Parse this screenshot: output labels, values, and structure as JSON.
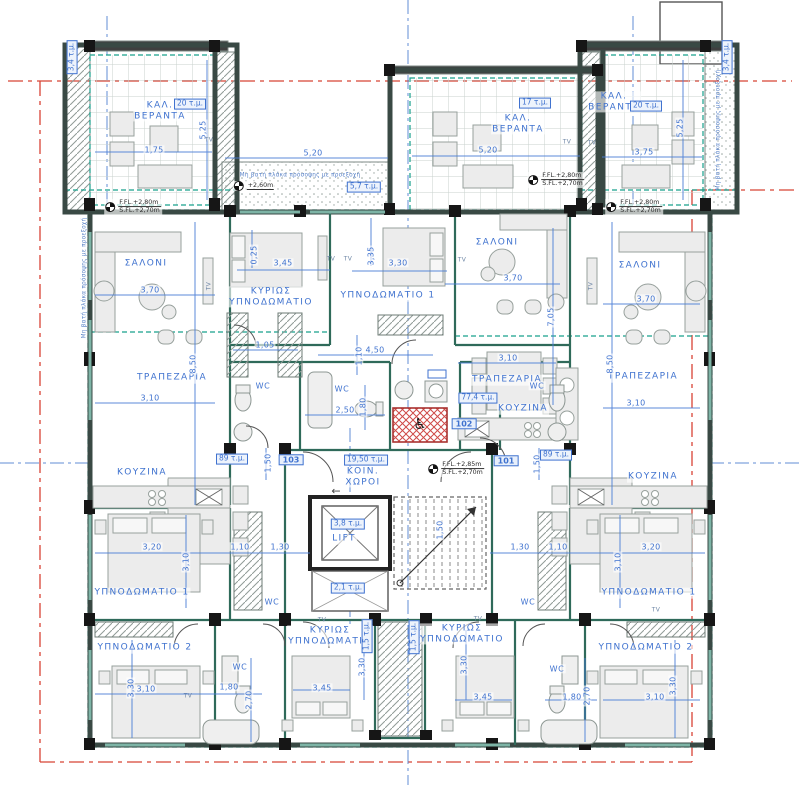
{
  "meta": {
    "drawing_type": "apartment-building-floor-plan",
    "colors": {
      "annotation_blue": "#3f72cf",
      "wall_dark": "#394944",
      "partition_teal": "#2f6a5a",
      "boundary_red": "#d84335",
      "axis_blue": "#4f7fd0",
      "envelope_teal": "#17a08c"
    }
  },
  "labels": [
    {
      "t": "ΣΑΛΟΝΙ",
      "x": 146,
      "y": 264,
      "c": "room"
    },
    {
      "t": "ΤΡΑΠΕΖΑΡΙΑ",
      "x": 172,
      "y": 378,
      "c": "room"
    },
    {
      "t": "ΚΟΥΖΙΝΑ",
      "x": 142,
      "y": 473,
      "c": "room"
    },
    {
      "t": "ΥΠΝΟΔΩΜΑΤΙΟ 1",
      "x": 142,
      "y": 593,
      "c": "room"
    },
    {
      "t": "ΥΠΝΟΔΩΜΑΤΙΟ 2",
      "x": 145,
      "y": 648,
      "c": "room"
    },
    {
      "t": "ΚΥΡΙΩΣ\nΥΠΝΟΔΩΜΑΤΙΟ",
      "x": 271,
      "y": 297,
      "c": "room"
    },
    {
      "t": "ΥΠΝΟΔΩΜΑΤΙΟ 1",
      "x": 388,
      "y": 296,
      "c": "room"
    },
    {
      "t": "ΣΑΛΟΝΙ",
      "x": 497,
      "y": 243,
      "c": "room"
    },
    {
      "t": "ΤΡΑΠΕΖΑΡΙΑ",
      "x": 507,
      "y": 380,
      "c": "room"
    },
    {
      "t": "ΚΟΥΖΙΝΑ",
      "x": 523,
      "y": 409,
      "c": "room"
    },
    {
      "t": "ΣΑΛΟΝΙ",
      "x": 640,
      "y": 266,
      "c": "room"
    },
    {
      "t": "ΤΡΑΠΕΖΑΡΙΑ",
      "x": 643,
      "y": 377,
      "c": "room"
    },
    {
      "t": "ΚΟΥΖΙΝΑ",
      "x": 653,
      "y": 477,
      "c": "room"
    },
    {
      "t": "ΥΠΝΟΔΩΜΑΤΙΟ 1",
      "x": 649,
      "y": 593,
      "c": "room"
    },
    {
      "t": "ΥΠΝΟΔΩΜΑΤΙΟ 2",
      "x": 646,
      "y": 648,
      "c": "room"
    },
    {
      "t": "ΚΥΡΙΩΣ\nΥΠΝΟΔΩΜΑΤΙΟ",
      "x": 330,
      "y": 636,
      "c": "room"
    },
    {
      "t": "ΚΥΡΙΩΣ\nΥΠΝΟΔΩΜΑΤΙΟ",
      "x": 462,
      "y": 634,
      "c": "room"
    },
    {
      "t": "ΚΑΛ.\nΒΕΡΑΝΤΑ",
      "x": 160,
      "y": 111,
      "c": "room"
    },
    {
      "t": "ΚΑΛ.\nΒΕΡΑΝΤΑ",
      "x": 518,
      "y": 124,
      "c": "room"
    },
    {
      "t": "ΚΑΛ.\nΒΕΡΑΝΤΑ",
      "x": 614,
      "y": 102,
      "c": "room"
    },
    {
      "t": "ΚΟΙΝ.\nΧΩΡΟΙ",
      "x": 363,
      "y": 477,
      "c": "room"
    },
    {
      "t": "LIFT",
      "x": 344,
      "y": 539,
      "c": "room"
    },
    {
      "t": "WC",
      "x": 263,
      "y": 386,
      "c": "wc"
    },
    {
      "t": "WC",
      "x": 342,
      "y": 389,
      "c": "wc"
    },
    {
      "t": "WC",
      "x": 537,
      "y": 386,
      "c": "wc"
    },
    {
      "t": "WC",
      "x": 272,
      "y": 602,
      "c": "wc"
    },
    {
      "t": "WC",
      "x": 528,
      "y": 602,
      "c": "wc"
    },
    {
      "t": "WC",
      "x": 240,
      "y": 667,
      "c": "wc"
    },
    {
      "t": "WC",
      "x": 557,
      "y": 669,
      "c": "wc"
    },
    {
      "t": "1,75",
      "x": 154,
      "y": 150,
      "c": "dim"
    },
    {
      "t": "5,20",
      "x": 313,
      "y": 153,
      "c": "dim"
    },
    {
      "t": "5,20",
      "x": 488,
      "y": 150,
      "c": "dim"
    },
    {
      "t": "3,75",
      "x": 644,
      "y": 152,
      "c": "dim"
    },
    {
      "t": "3,70",
      "x": 150,
      "y": 290,
      "c": "dim"
    },
    {
      "t": "3,45",
      "x": 283,
      "y": 263,
      "c": "dim"
    },
    {
      "t": "3,30",
      "x": 398,
      "y": 263,
      "c": "dim"
    },
    {
      "t": "3,70",
      "x": 513,
      "y": 278,
      "c": "dim"
    },
    {
      "t": "3,70",
      "x": 646,
      "y": 299,
      "c": "dim"
    },
    {
      "t": "1,05",
      "x": 265,
      "y": 345,
      "c": "dim"
    },
    {
      "t": "4,50",
      "x": 375,
      "y": 350,
      "c": "dim"
    },
    {
      "t": "3,10",
      "x": 150,
      "y": 398,
      "c": "dim"
    },
    {
      "t": "3,10",
      "x": 508,
      "y": 358,
      "c": "dim"
    },
    {
      "t": "2,50",
      "x": 345,
      "y": 410,
      "c": "dim"
    },
    {
      "t": "3,10",
      "x": 636,
      "y": 403,
      "c": "dim"
    },
    {
      "t": "3,20",
      "x": 152,
      "y": 547,
      "c": "dim"
    },
    {
      "t": "1,10",
      "x": 240,
      "y": 547,
      "c": "dim"
    },
    {
      "t": "1,30",
      "x": 280,
      "y": 547,
      "c": "dim"
    },
    {
      "t": "1,30",
      "x": 520,
      "y": 547,
      "c": "dim"
    },
    {
      "t": "1,10",
      "x": 558,
      "y": 547,
      "c": "dim"
    },
    {
      "t": "3,20",
      "x": 651,
      "y": 547,
      "c": "dim"
    },
    {
      "t": "3,10",
      "x": 146,
      "y": 689,
      "c": "dim"
    },
    {
      "t": "1,80",
      "x": 229,
      "y": 687,
      "c": "dim"
    },
    {
      "t": "3,45",
      "x": 322,
      "y": 688,
      "c": "dim"
    },
    {
      "t": "3,45",
      "x": 483,
      "y": 697,
      "c": "dim"
    },
    {
      "t": "1,80",
      "x": 572,
      "y": 697,
      "c": "dim"
    },
    {
      "t": "3,10",
      "x": 655,
      "y": 697,
      "c": "dim"
    },
    {
      "t": "5,25",
      "x": 203,
      "y": 130,
      "c": "dim",
      "r": -90
    },
    {
      "t": "5,25",
      "x": 680,
      "y": 128,
      "c": "dim",
      "r": -90
    },
    {
      "t": "0,25",
      "x": 254,
      "y": 255,
      "c": "dim",
      "r": -90
    },
    {
      "t": "3,35",
      "x": 371,
      "y": 256,
      "c": "dim",
      "r": -90
    },
    {
      "t": "7,05",
      "x": 551,
      "y": 317,
      "c": "dim",
      "r": -90
    },
    {
      "t": "8,50",
      "x": 193,
      "y": 364,
      "c": "dim",
      "r": -90
    },
    {
      "t": "8,50",
      "x": 610,
      "y": 364,
      "c": "dim",
      "r": -90
    },
    {
      "t": "1,10",
      "x": 359,
      "y": 356,
      "c": "dim",
      "r": -90
    },
    {
      "t": "1,80",
      "x": 363,
      "y": 407,
      "c": "dim",
      "r": -90
    },
    {
      "t": "3,10",
      "x": 186,
      "y": 562,
      "c": "dim",
      "r": -90
    },
    {
      "t": "3,10",
      "x": 618,
      "y": 562,
      "c": "dim",
      "r": -90
    },
    {
      "t": "1,50",
      "x": 268,
      "y": 463,
      "c": "dim",
      "r": -90
    },
    {
      "t": "1,50",
      "x": 537,
      "y": 464,
      "c": "dim",
      "r": -90
    },
    {
      "t": "1,50",
      "x": 440,
      "y": 530,
      "c": "dim",
      "r": -90
    },
    {
      "t": "3,30",
      "x": 362,
      "y": 667,
      "c": "dim",
      "r": -90
    },
    {
      "t": "3,30",
      "x": 464,
      "y": 665,
      "c": "dim",
      "r": -90
    },
    {
      "t": "3,30",
      "x": 131,
      "y": 688,
      "c": "dim",
      "r": -90
    },
    {
      "t": "3,30",
      "x": 673,
      "y": 686,
      "c": "dim",
      "r": -90
    },
    {
      "t": "2,70",
      "x": 249,
      "y": 700,
      "c": "dim",
      "r": -90
    },
    {
      "t": "2,70",
      "x": 587,
      "y": 696,
      "c": "dim",
      "r": -90
    },
    {
      "t": "20 τ.μ.",
      "x": 190,
      "y": 104,
      "c": "area"
    },
    {
      "t": "17 τ.μ.",
      "x": 535,
      "y": 103,
      "c": "area"
    },
    {
      "t": "20 τ.μ.",
      "x": 646,
      "y": 106,
      "c": "area"
    },
    {
      "t": "5,7 τ.μ.",
      "x": 364,
      "y": 187,
      "c": "area"
    },
    {
      "t": "89 τ.μ.",
      "x": 232,
      "y": 459,
      "c": "area"
    },
    {
      "t": "89 τ.μ.",
      "x": 556,
      "y": 455,
      "c": "area"
    },
    {
      "t": "77,4 τ.μ.",
      "x": 478,
      "y": 398,
      "c": "area"
    },
    {
      "t": "19,50 τ.μ.",
      "x": 366,
      "y": 460,
      "c": "area"
    },
    {
      "t": "3,8 τ.μ.",
      "x": 348,
      "y": 524,
      "c": "area"
    },
    {
      "t": "2,1 τ.μ.",
      "x": 348,
      "y": 588,
      "c": "area"
    },
    {
      "t": "3,4 τ.μ.",
      "x": 72,
      "y": 57,
      "c": "area",
      "r": -90
    },
    {
      "t": "3,4 τ.μ.",
      "x": 727,
      "y": 57,
      "c": "area",
      "r": -90
    },
    {
      "t": "1,5 τ.μ.",
      "x": 367,
      "y": 636,
      "c": "area",
      "r": -90
    },
    {
      "t": "1,5 τ.μ.",
      "x": 414,
      "y": 637,
      "c": "area",
      "r": -90
    },
    {
      "t": "101",
      "x": 506,
      "y": 461,
      "c": "unit"
    },
    {
      "t": "102",
      "x": 464,
      "y": 424,
      "c": "unit"
    },
    {
      "t": "103",
      "x": 291,
      "y": 460,
      "c": "unit"
    },
    {
      "t": "TV",
      "x": 209,
      "y": 140,
      "c": "tv"
    },
    {
      "t": "TV",
      "x": 567,
      "y": 142,
      "c": "tv"
    },
    {
      "t": "TV",
      "x": 592,
      "y": 143,
      "c": "tv"
    },
    {
      "t": "TV",
      "x": 331,
      "y": 259,
      "c": "tv"
    },
    {
      "t": "TV",
      "x": 348,
      "y": 259,
      "c": "tv"
    },
    {
      "t": "TV",
      "x": 462,
      "y": 260,
      "c": "tv"
    },
    {
      "t": "TV",
      "x": 209,
      "y": 286,
      "c": "tv",
      "r": -90
    },
    {
      "t": "TV",
      "x": 591,
      "y": 286,
      "c": "tv",
      "r": -90
    },
    {
      "t": "TV",
      "x": 188,
      "y": 696,
      "c": "tv"
    },
    {
      "t": "TV",
      "x": 322,
      "y": 620,
      "c": "tv"
    },
    {
      "t": "TV",
      "x": 478,
      "y": 619,
      "c": "tv"
    },
    {
      "t": "TV",
      "x": 656,
      "y": 610,
      "c": "tv"
    },
    {
      "t": "Μη βατή πλάκα πρόσοψης με προεξοχή",
      "x": 300,
      "y": 176,
      "c": "note"
    },
    {
      "t": "Μη βατή πλάκα πρόσοψης με προεξοχή",
      "x": 719,
      "y": 130,
      "c": "note",
      "r": -90
    },
    {
      "t": "Μη βατή πλάκα πρόσοψης με προεξοχή",
      "x": 85,
      "y": 278,
      "c": "note",
      "r": -90
    },
    {
      "t": "♿",
      "x": 420,
      "y": 425,
      "c": "glyph"
    },
    {
      "t": "←",
      "x": 336,
      "y": 492,
      "c": "arrow"
    }
  ],
  "levels": [
    {
      "a": "F.FL.+2,80m",
      "b": "S.FL.+2,70m",
      "x": 133,
      "y": 207
    },
    {
      "a": "F.FL.+2,80m",
      "b": "S.FL.+2,70m",
      "x": 556,
      "y": 180
    },
    {
      "a": "F.FL.+2,80m",
      "b": "S.FL.+2,70m",
      "x": 634,
      "y": 207
    },
    {
      "a": "F.FL.+2,85m",
      "b": "S.FL.+2,70m",
      "x": 456,
      "y": 469
    },
    {
      "a": "+2,60m",
      "b": "",
      "x": 254,
      "y": 186
    }
  ]
}
